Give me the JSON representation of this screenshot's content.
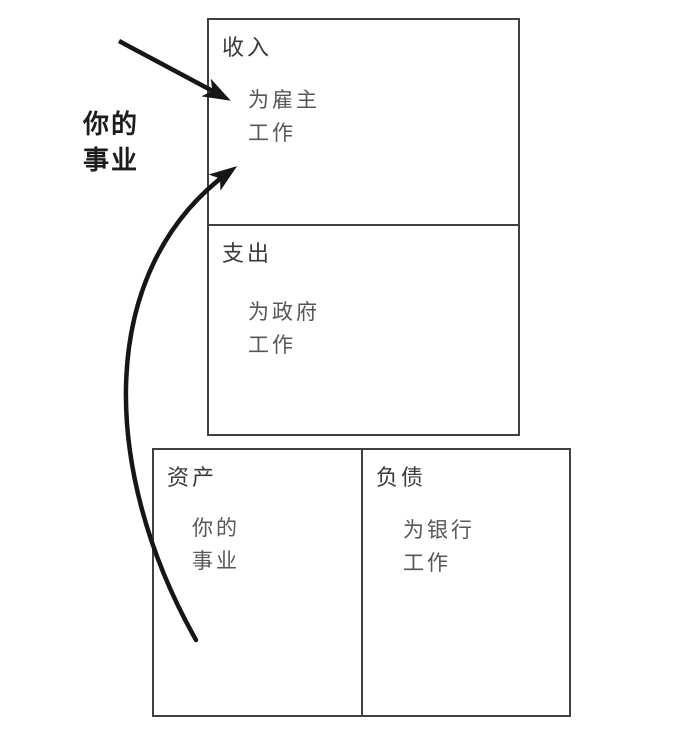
{
  "side_label": {
    "line1": "你的",
    "line2": "事业"
  },
  "income_statement": {
    "income": {
      "title": "收入",
      "note": {
        "line1": "为雇主",
        "line2": "工作"
      }
    },
    "expenses": {
      "title": "支出",
      "note": {
        "line1": "为政府",
        "line2": "工作"
      }
    }
  },
  "balance_sheet": {
    "assets": {
      "title": "资产",
      "note": {
        "line1": "你的",
        "line2": "事业"
      }
    },
    "liabilities": {
      "title": "负债",
      "note": {
        "line1": "为银行",
        "line2": "工作"
      }
    }
  },
  "arrows": {
    "straight_arrow_target": "income-box",
    "curved_arrow_from": "assets-area",
    "curved_arrow_to": "income-box"
  },
  "colors": {
    "background": "#ffffff",
    "border": "#404040",
    "title_text": "#3a3a3a",
    "note_text": "#575757",
    "side_label_text": "#1c1c1c",
    "arrow": "#161616"
  }
}
